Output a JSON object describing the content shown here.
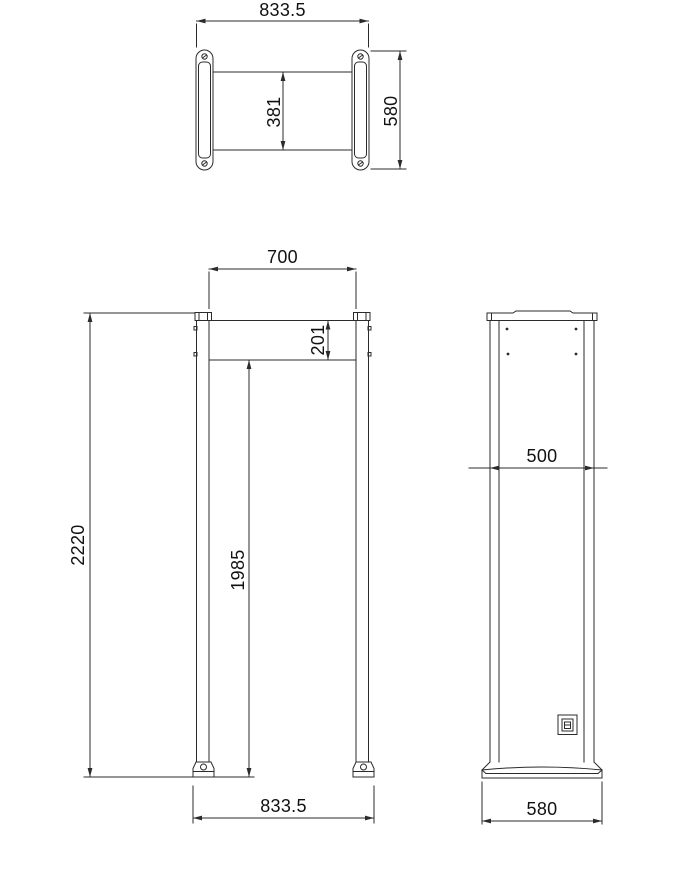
{
  "palette": {
    "background": "#ffffff",
    "line": "#2b2b2b",
    "text": "#111111"
  },
  "views": {
    "top_view": {
      "dims": {
        "overall_width": "833.5",
        "tunnel_depth": "381",
        "column_depth": "580"
      }
    },
    "front_view": {
      "dims": {
        "tunnel_width": "700",
        "header_height": "201",
        "overall_height": "2220",
        "tunnel_height": "1985",
        "overall_width": "833.5"
      }
    },
    "side_view": {
      "dims": {
        "column_width": "500",
        "base_depth": "580"
      }
    }
  },
  "icons": {
    "screw_hole": "circle-with-slash",
    "anchor_hole": "circle",
    "corner_screw": "dot",
    "power_inlet": "socket-rectangle"
  }
}
